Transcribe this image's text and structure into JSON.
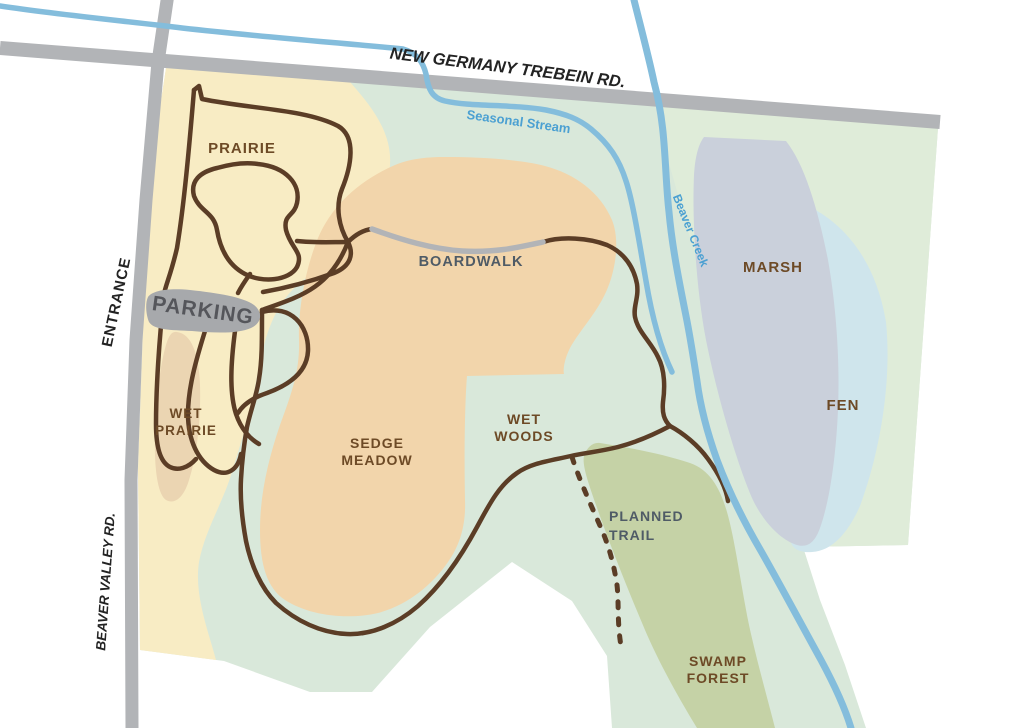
{
  "map": {
    "title": "Nature preserve trail map",
    "roads": {
      "top_road": "NEW GERMANY TREBEIN RD.",
      "left_road": "BEAVER VALLEY RD.",
      "entrance": "ENTRANCE"
    },
    "parking": {
      "label": "PARKING"
    },
    "areas": {
      "prairie": {
        "label": "PRAIRIE"
      },
      "wet_prairie": {
        "line1": "WET",
        "line2": "PRAIRIE"
      },
      "sedge_meadow": {
        "line1": "SEDGE",
        "line2": "MEADOW"
      },
      "wet_woods": {
        "line1": "WET",
        "line2": "WOODS"
      },
      "marsh": {
        "label": "MARSH"
      },
      "fen": {
        "label": "FEN"
      },
      "swamp_forest": {
        "line1": "SWAMP",
        "line2": "FOREST"
      }
    },
    "trails": {
      "boardwalk": {
        "label": "BOARDWALK"
      },
      "planned_trail": {
        "line1": "PLANNED",
        "line2": "TRAIL"
      }
    },
    "streams": {
      "seasonal_stream": {
        "label": "Seasonal Stream"
      },
      "beaver_creek": {
        "label": "Beaver Creek"
      }
    },
    "colors": {
      "background": "#ffffff",
      "prairie_yellow": "#f8ecc4",
      "wetwoods_green": "#d9e8da",
      "northeast_green": "#dfecd9",
      "sedge_orange": "#f2d5ab",
      "wet_prairie_tan": "#ebd5b2",
      "marsh_gray": "#cad0db",
      "fen_blue": "#cfe5ec",
      "swamp_olive": "#c5d2a6",
      "road_gray": "#b2b4b7",
      "parking_gray": "#a7a9ac",
      "trail_brown": "#5b3d26",
      "boardwalk_gray": "#b2b4b7",
      "stream_blue": "#84bddc",
      "label_brown": "#6d4a26",
      "label_slate": "#4f5b66",
      "label_parking": "#55565b",
      "label_black": "#232323",
      "label_stream_blue": "#4ba0d2"
    }
  }
}
